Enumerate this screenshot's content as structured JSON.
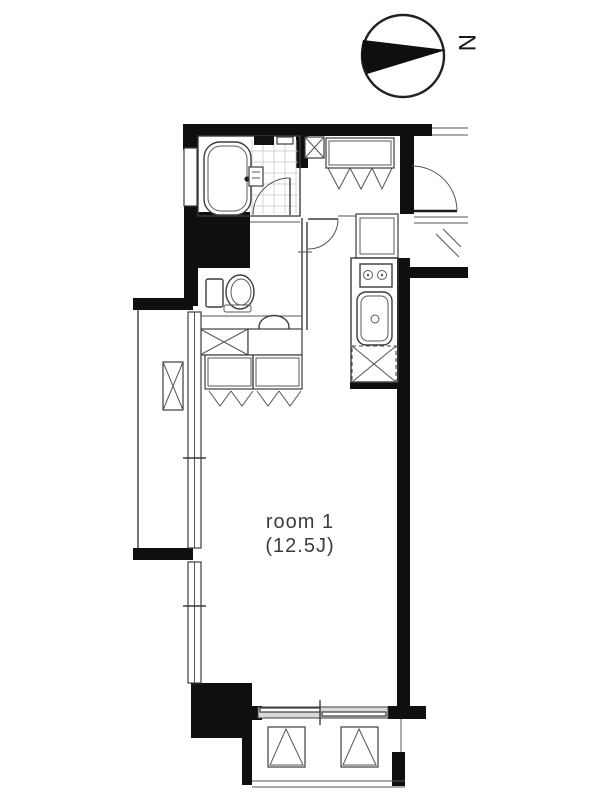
{
  "palette": {
    "background": "#ffffff",
    "wall": "#0f0f0f",
    "line": "#3c3c3c",
    "tile_line": "#c9c9c9",
    "glass_gray": "#d9d9d9",
    "label_text": "#3c3c3c"
  },
  "compass": {
    "label": "N",
    "direction": "north-points-right"
  },
  "room": {
    "name": "room 1",
    "size": "(12.5J)"
  },
  "fixtures": [
    "bathtub",
    "bathroom-door",
    "shower-mixer",
    "pipe-shaft-x-box",
    "entry-shoe-closet-bifold",
    "entry-door",
    "washroom-door",
    "toilet",
    "washbasin-oval",
    "washer-space-x-box",
    "closet-bifold-doors",
    "kitchen-cabinet",
    "stove-two-burner",
    "kitchen-sink",
    "refrigerator-space-dashed-x",
    "left-balcony",
    "balcony-ac-box",
    "sliding-windows",
    "bottom-balcony",
    "balcony-sliding-door",
    "planter-triangle-boxes"
  ]
}
